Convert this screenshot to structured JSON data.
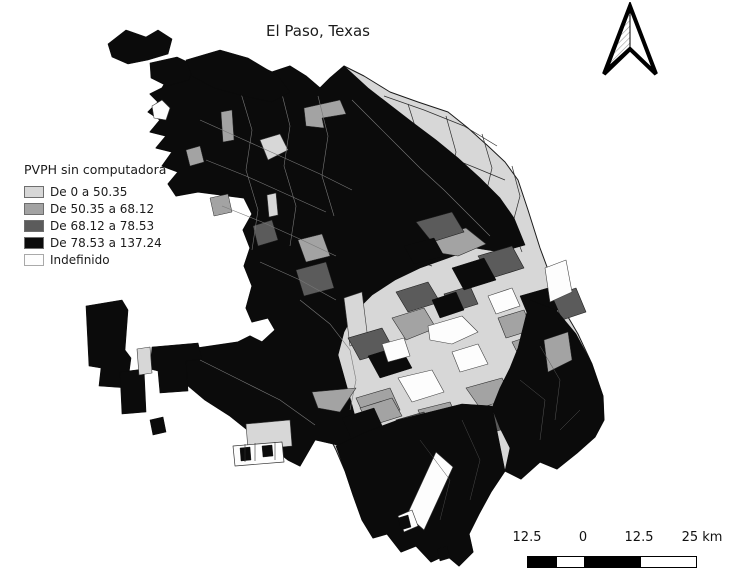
{
  "figure": {
    "title": "El Paso, Texas"
  },
  "legend": {
    "title": "PVPH sin computadora",
    "items": [
      {
        "label": "De 0 a 50.35",
        "color": "#d7d7d7",
        "border": "#6e6e6e"
      },
      {
        "label": "De 50.35 a 68.12",
        "color": "#a3a3a3",
        "border": "#6e6e6e"
      },
      {
        "label": "De 68.12 a 78.53",
        "color": "#5b5b5b",
        "border": "#6e6e6e"
      },
      {
        "label": "De 78.53 a 137.24",
        "color": "#0b0b0b",
        "border": "#6e6e6e"
      },
      {
        "label": "Indefinido",
        "color": "#fdfdfd",
        "border": "#a9a9a9"
      }
    ]
  },
  "scale_bar": {
    "labels": [
      "12.5",
      "0",
      "12.5",
      "25 km"
    ],
    "label_offsets_px": [
      22,
      78,
      134,
      197
    ],
    "segments": [
      {
        "width": 28,
        "color": "#000000"
      },
      {
        "width": 28,
        "color": "#ffffff"
      },
      {
        "width": 56,
        "color": "#000000"
      },
      {
        "width": 56,
        "color": "#ffffff"
      }
    ]
  },
  "map": {
    "palette": {
      "c1": "#d7d7d7",
      "c2": "#a3a3a3",
      "c3": "#5b5b5b",
      "c4": "#0b0b0b",
      "und": "#fdfdfd"
    },
    "layers": [
      {
        "name": "city-base",
        "type": "fill",
        "class": "c1",
        "outline": "#1a1a1a",
        "outlineWidth": 1,
        "paths": [
          "M168,78 L182,68 L198,58 L216,66 L230,58 L254,64 L272,72 L290,66 L306,76 L320,88 L330,78 L344,66 L364,76 L390,92 L418,102 L448,112 L468,128 L488,146 L505,162 L518,180 L528,210 L540,248 L553,283 L564,310 L578,334 L592,364 L603,396 L604,420 L595,437 L577,453 L557,469 L540,462 L521,479 L505,471 L491,492 L479,514 L469,534 L473,552 L459,566 L446,555 L431,562 L416,546 L401,552 L387,534 L373,538 L362,520 L353,495 L345,471 L336,450 L326,430 L315,440 L300,466 L288,460 L270,446 L250,432 L230,416 L205,400 L186,384 L172,364 L170,352 L238,342 L250,336 L262,342 L275,330 L268,318 L252,322 L246,308 L252,286 L244,266 L250,248 L243,230 L252,214 L244,198 L198,192 L176,196 L168,184 L178,172 L162,166 L172,152 L156,148 L166,136 L150,132 L160,120 L148,112 L158,102 L150,94 L162,88 Z"
        ]
      },
      {
        "name": "lobe-tract-lines",
        "type": "line",
        "stroke": "#2e2e2e",
        "width": 0.7,
        "paths": [
          "M372,92 L386,130 L378,168 L394,205 L386,242",
          "M408,104 L420,142 L412,180 L428,218 L420,252",
          "M446,116 L456,152 L448,188 L462,224",
          "M482,134 L492,168 L484,202 L496,232",
          "M512,166 L520,196 L512,226 L522,252",
          "M356,120 L396,136 L436,152 L476,168 L505,180",
          "M348,158 L388,174 L428,190 L468,206 L502,220",
          "M342,196 L382,212 L422,228 L462,244",
          "M352,238 L392,252 L432,266",
          "M384,96 L424,110 L464,126 L497,146"
        ]
      },
      {
        "name": "west-black-core",
        "type": "fill",
        "class": "c4",
        "outline": "#0b0b0b",
        "outlineWidth": 0.6,
        "paths": [
          "M168,78 L182,68 L198,58 L216,66 L230,58 L254,64 L272,72 L290,66 L306,76 L320,88 L330,78 L344,66 L368,88 L390,105 L412,122 L436,140 L458,158 L480,178 L500,198 L514,218 L525,245 L500,252 L475,248 L448,258 L420,268 L395,280 L372,295 L355,312 L344,332 L338,355 L345,380 L352,405 L358,428 L350,448 L315,440 L300,466 L288,460 L270,446 L250,432 L230,416 L205,400 L186,384 L172,364 L170,352 L238,342 L250,336 L262,342 L275,330 L268,318 L252,322 L246,308 L252,286 L244,266 L250,248 L243,230 L252,214 L244,198 L198,192 L176,196 L168,184 L178,172 L162,166 L172,152 L156,148 L166,136 L150,132 L160,120 L148,112 L158,102 L150,94 L162,88 Z"
        ]
      },
      {
        "name": "core-inclusions-light",
        "type": "fill",
        "class": "c1",
        "outline": "#3a3a3a",
        "outlineWidth": 0.6,
        "paths": [
          "M260,140 L280,134 L288,150 L268,160 Z",
          "M267,195 L276,193 L278,215 L269,217 Z",
          "M344,298 L362,292 L368,340 L350,346 Z"
        ]
      },
      {
        "name": "core-inclusions-white",
        "type": "fill",
        "class": "und",
        "outline": "#3a3a3a",
        "outlineWidth": 0.6,
        "paths": [
          "M152,106 L162,100 L170,108 L166,120 L154,118 Z"
        ]
      },
      {
        "name": "core-inclusions-medium",
        "type": "fill",
        "class": "c2",
        "outline": "#2c2c2c",
        "outlineWidth": 0.5,
        "paths": [
          "M304,108 L340,100 L346,114 L322,118 L324,128 L306,126 Z",
          "M221,112 L232,110 L234,140 L223,142 Z",
          "M186,150 L200,146 L204,162 L190,166 Z",
          "M210,198 L228,194 L232,212 L214,216 Z",
          "M298,240 L322,234 L330,256 L306,262 Z"
        ]
      },
      {
        "name": "core-inclusions-dark",
        "type": "fill",
        "class": "c3",
        "outline": "#1d1d1d",
        "outlineWidth": 0.5,
        "paths": [
          "M253,226 L272,220 L278,240 L258,246 Z",
          "M296,270 L326,262 L334,288 L304,296 Z"
        ]
      },
      {
        "name": "core-tract-lines",
        "type": "line",
        "stroke": "#787878",
        "width": 0.6,
        "paths": [
          "M240,90 L252,130 L246,170 L258,210 L252,250",
          "M280,86 L290,126 L284,166 L296,206 L290,246",
          "M318,96 L328,136 L322,176 L334,216",
          "M200,120 L240,138 L280,156 L320,174 L352,190",
          "M206,160 L246,176 L286,194 L326,212",
          "M222,206 L262,222 L302,240 L336,256",
          "M352,100 L376,124 L398,146 L420,168 L444,190 L468,214 L490,236",
          "M260,262 L300,280 L336,300",
          "M300,300 L330,324 L350,350 L356,380 L350,410",
          "M200,360 L240,380 L280,400 L315,425"
        ]
      },
      {
        "name": "center-medium",
        "type": "fill",
        "class": "c2",
        "outline": "#2c2c2c",
        "outlineWidth": 0.6,
        "paths": [
          "M430,238 L466,228 L486,244 L458,256 L434,252 Z",
          "M392,318 L424,308 L436,328 L406,340 Z",
          "M466,388 L502,378 L512,398 L480,408 Z",
          "M512,342 L542,332 L554,356 L524,366 Z",
          "M356,398 L390,388 L400,410 L366,420 Z",
          "M418,410 L450,402 L458,420 L426,428 Z",
          "M498,318 L524,310 L532,330 L506,338 Z",
          "M312,392 L356,388 L340,412 L318,408 Z",
          "M360,408 L392,398 L402,416 L370,426 Z"
        ]
      },
      {
        "name": "center-dark",
        "type": "fill",
        "class": "c3",
        "outline": "#1d1d1d",
        "outlineWidth": 0.6,
        "paths": [
          "M416,222 L452,212 L464,232 L432,242 Z",
          "M478,256 L512,246 L524,268 L492,278 Z",
          "M396,292 L428,282 L440,302 L408,312 Z",
          "M348,338 L382,328 L394,350 L360,360 Z",
          "M502,418 L540,406 L552,428 L514,440 Z",
          "M552,296 L576,288 L586,312 L562,320 Z",
          "M444,294 L470,286 L478,304 L452,312 Z",
          "M470,418 L500,410 L508,428 L478,436 Z",
          "M396,420 L424,412 L432,430 L404,438 Z"
        ]
      },
      {
        "name": "center-black",
        "type": "fill",
        "class": "c4",
        "outline": "#0b0b0b",
        "outlineWidth": 0.5,
        "paths": [
          "M452,268 L484,258 L496,280 L464,290 Z",
          "M368,356 L400,346 L412,368 L380,378 Z",
          "M520,296 L548,288 L558,310 L530,320 Z",
          "M432,300 L456,292 L464,310 L440,318 Z",
          "M404,246 L434,238 L444,256 L414,264 Z",
          "M342,418 L374,408 L384,430 L352,440 Z"
        ]
      },
      {
        "name": "center-undefined",
        "type": "fill",
        "class": "und",
        "outline": "#444444",
        "outlineWidth": 0.6,
        "paths": [
          "M428,326 L462,316 L478,332 L452,344 L430,340 Z",
          "M398,378 L432,370 L444,392 L412,402 Z",
          "M452,352 L478,344 L488,364 L460,372 Z",
          "M488,296 L512,288 L520,306 L496,314 Z",
          "M545,268 L566,260 L572,292 L550,302 Z",
          "M382,344 L404,338 L410,356 L388,362 Z",
          "M372,430 L396,424 L402,440 L378,446 Z"
        ]
      },
      {
        "name": "edge-light-block",
        "type": "fill",
        "class": "c1",
        "outline": "#3a3a3a",
        "outlineWidth": 0.6,
        "paths": [
          "M246,424 L290,420 L292,446 L248,450 Z"
        ]
      },
      {
        "name": "edge-white-cluster",
        "type": "fill",
        "class": "und",
        "outline": "#333333",
        "outlineWidth": 0.7,
        "paths": [
          "M233,446 L282,442 L284,462 L235,466 Z"
        ]
      },
      {
        "name": "edge-cluster-bits",
        "type": "fill",
        "class": "c4",
        "outline": "#0b0b0b",
        "outlineWidth": 0.4,
        "paths": [
          "M240,448 L250,447 L251,460 L241,461 Z",
          "M262,446 L272,445 L273,456 L263,457 Z"
        ]
      },
      {
        "name": "edge-cluster-lines",
        "type": "line",
        "stroke": "#333333",
        "width": 0.6,
        "paths": [
          "M245,444 L245,462",
          "M255,443 L255,461",
          "M275,442 L275,460"
        ]
      },
      {
        "name": "se-wedge",
        "type": "fill",
        "class": "c4",
        "outline": "#0b0b0b",
        "outlineWidth": 0.6,
        "paths": [
          "M530,300 L556,310 L576,334 L592,364 L603,396 L604,420 L595,437 L577,453 L557,469 L540,462 L521,479 L505,471 L510,448 L500,428 L492,408 L500,388 L510,368 L518,348 L524,324 Z"
        ]
      },
      {
        "name": "se-wedge-medium",
        "type": "fill",
        "class": "c2",
        "outline": "#2c2c2c",
        "outlineWidth": 0.5,
        "paths": [
          "M544,340 L568,332 L572,360 L548,372 Z"
        ]
      },
      {
        "name": "se-wedge-lines",
        "type": "line",
        "stroke": "#555555",
        "width": 0.5,
        "paths": [
          "M540,346 L560,380 L555,420",
          "M520,380 L545,400 L540,440",
          "M560,430 L580,410"
        ]
      },
      {
        "name": "south-tip",
        "type": "fill",
        "class": "c4",
        "outline": "#0b0b0b",
        "outlineWidth": 0.6,
        "paths": [
          "M336,446 L366,432 L398,420 L430,412 L462,404 L492,406 L505,471 L491,492 L479,514 L469,534 L473,552 L459,566 L446,555 L431,562 L416,546 L401,552 L387,534 L373,538 L362,520 L353,495 L345,471 Z"
        ]
      },
      {
        "name": "south-tip-strip",
        "type": "fill",
        "class": "und",
        "outline": "#333333",
        "outlineWidth": 0.6,
        "paths": [
          "M436,452 L453,467 L424,530 L407,515 Z",
          "M398,516 L412,510 L418,526 L404,532 Z"
        ]
      },
      {
        "name": "south-tip-lines",
        "type": "line",
        "stroke": "#4a4a4a",
        "width": 0.5,
        "paths": [
          "M420,440 L450,480 L440,520",
          "M462,420 L480,460 L470,500"
        ]
      },
      {
        "name": "south-specks",
        "type": "fill",
        "class": "c4",
        "outline": "#0b0b0b",
        "outlineWidth": 0.4,
        "paths": [
          "M398,518 L408,515 L411,527 L401,530 Z",
          "M437,549 L447,546 L450,558 L440,561 Z"
        ]
      },
      {
        "name": "west-detached",
        "type": "fill",
        "class": "c4",
        "outline": "#0b0b0b",
        "outlineWidth": 0.6,
        "paths": [
          "M86,306 L122,300 L128,310 L125,350 L131,358 L127,388 L99,386 L101,368 L89,366 Z",
          "M120,372 L144,369 L146,412 L122,414 Z",
          "M152,347 L198,343 L202,359 L186,361 L188,391 L160,393 L158,371 L150,369 Z",
          "M150,420 L163,417 L166,432 L153,435 Z"
        ]
      },
      {
        "name": "west-detached-light",
        "type": "fill",
        "class": "c1",
        "outline": "#3a3a3a",
        "outlineWidth": 0.6,
        "paths": [
          "M137,349 L150,347 L152,373 L139,375 Z"
        ]
      },
      {
        "name": "nw-archipelago",
        "type": "fill",
        "class": "c4",
        "outline": "#0b0b0b",
        "outlineWidth": 0.6,
        "paths": [
          "M108,44 L126,30 L146,37 L158,30 L172,39 L168,54 L148,60 L128,64 L112,57 Z",
          "M150,63 L177,57 L194,65 L189,80 L167,86 L151,78 Z",
          "M186,60 L220,50 L248,58 L278,76 L290,92 L272,102 L244,96 L214,88 L192,76 Z"
        ]
      }
    ]
  }
}
